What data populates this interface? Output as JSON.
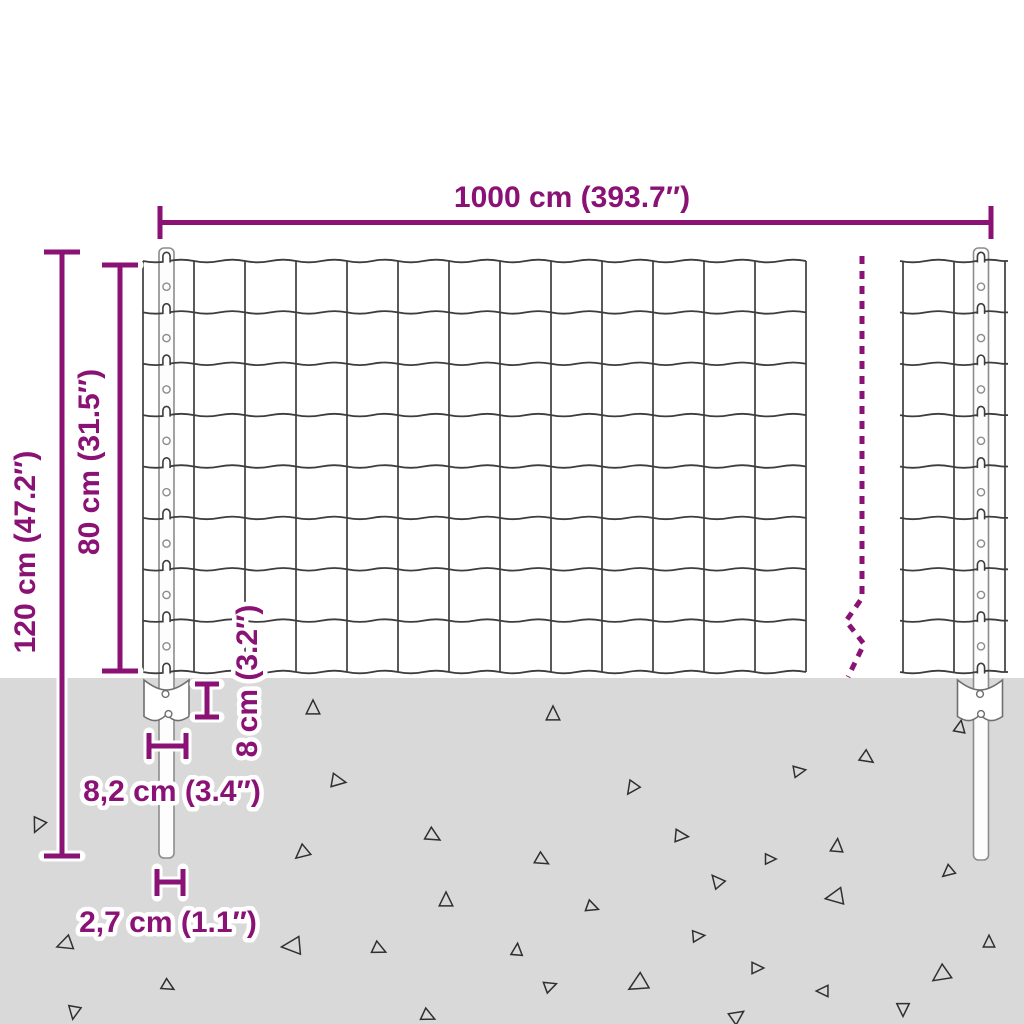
{
  "diagram": {
    "type": "product-dimension-diagram",
    "subject": "wire-mesh-fence-with-posts-and-anchor-plates"
  },
  "colors": {
    "accent": "#8a1275",
    "ground": "#d9d9d9",
    "wire": "#3d3d3d",
    "post_outline": "#8c8c8c",
    "triangle": "#2f2f2f",
    "halo": "#ffffff",
    "background": "#ffffff"
  },
  "labels": {
    "width": "1000 cm (393.7″)",
    "total_height": "120 cm (47.2″)",
    "fence_height": "80 cm (31.5″)",
    "plate_height": "8 cm (3.2″)",
    "plate_width": "8,2 cm (3.4″)",
    "post_width": "2,7 cm (1.1″)"
  },
  "scene": {
    "ground": {
      "top_y": 678,
      "triangles": [
        [
          38,
          825,
          13,
          205
        ],
        [
          313,
          708,
          13,
          0
        ],
        [
          553,
          714,
          13,
          0
        ],
        [
          338,
          781,
          13,
          100
        ],
        [
          632,
          788,
          12,
          215
        ],
        [
          433,
          836,
          13,
          120
        ],
        [
          681,
          836,
          12,
          95
        ],
        [
          302,
          853,
          13,
          230
        ],
        [
          542,
          860,
          12,
          120
        ],
        [
          717,
          881,
          12,
          320
        ],
        [
          446,
          900,
          13,
          0
        ],
        [
          592,
          907,
          11,
          110
        ],
        [
          292,
          946,
          17,
          265
        ],
        [
          379,
          949,
          12,
          115
        ],
        [
          517,
          950,
          11,
          5
        ],
        [
          698,
          936,
          11,
          85
        ],
        [
          550,
          986,
          11,
          70
        ],
        [
          638,
          984,
          17,
          240
        ],
        [
          757,
          968,
          11,
          90
        ],
        [
          428,
          1016,
          12,
          115
        ],
        [
          737,
          1016,
          13,
          55
        ],
        [
          960,
          727,
          11,
          10
        ],
        [
          867,
          758,
          12,
          125
        ],
        [
          799,
          771,
          11,
          80
        ],
        [
          837,
          846,
          12,
          5
        ],
        [
          770,
          859,
          10,
          90
        ],
        [
          948,
          872,
          11,
          230
        ],
        [
          835,
          897,
          16,
          260
        ],
        [
          989,
          942,
          11,
          0
        ],
        [
          941,
          975,
          16,
          235
        ],
        [
          823,
          991,
          11,
          270
        ],
        [
          903,
          1009,
          12,
          180
        ],
        [
          65,
          944,
          14,
          250
        ],
        [
          168,
          986,
          11,
          120
        ],
        [
          74,
          1012,
          12,
          190
        ]
      ]
    },
    "mesh": {
      "rows": 8,
      "columns_main": 13,
      "columns_right": 2,
      "rows_y": [
        261,
        312.4,
        363.8,
        415.1,
        466.5,
        517.9,
        569.3,
        620.6,
        672
      ],
      "panels": [
        {
          "x0": 143,
          "x1": 806,
          "verticals": [
            143,
            194,
            245,
            296,
            347,
            398,
            449,
            500,
            551,
            602,
            653,
            704,
            755,
            806
          ]
        },
        {
          "x0": 900,
          "x1": 1008,
          "verticals": [
            903,
            954,
            1005
          ]
        }
      ],
      "wave_period": 51,
      "wave_amp": 2.6
    },
    "posts": [
      {
        "cx": 166.5,
        "top": 248,
        "bottom": 858,
        "width": 15
      },
      {
        "cx": 981,
        "top": 248,
        "bottom": 860,
        "width": 15
      }
    ]
  }
}
